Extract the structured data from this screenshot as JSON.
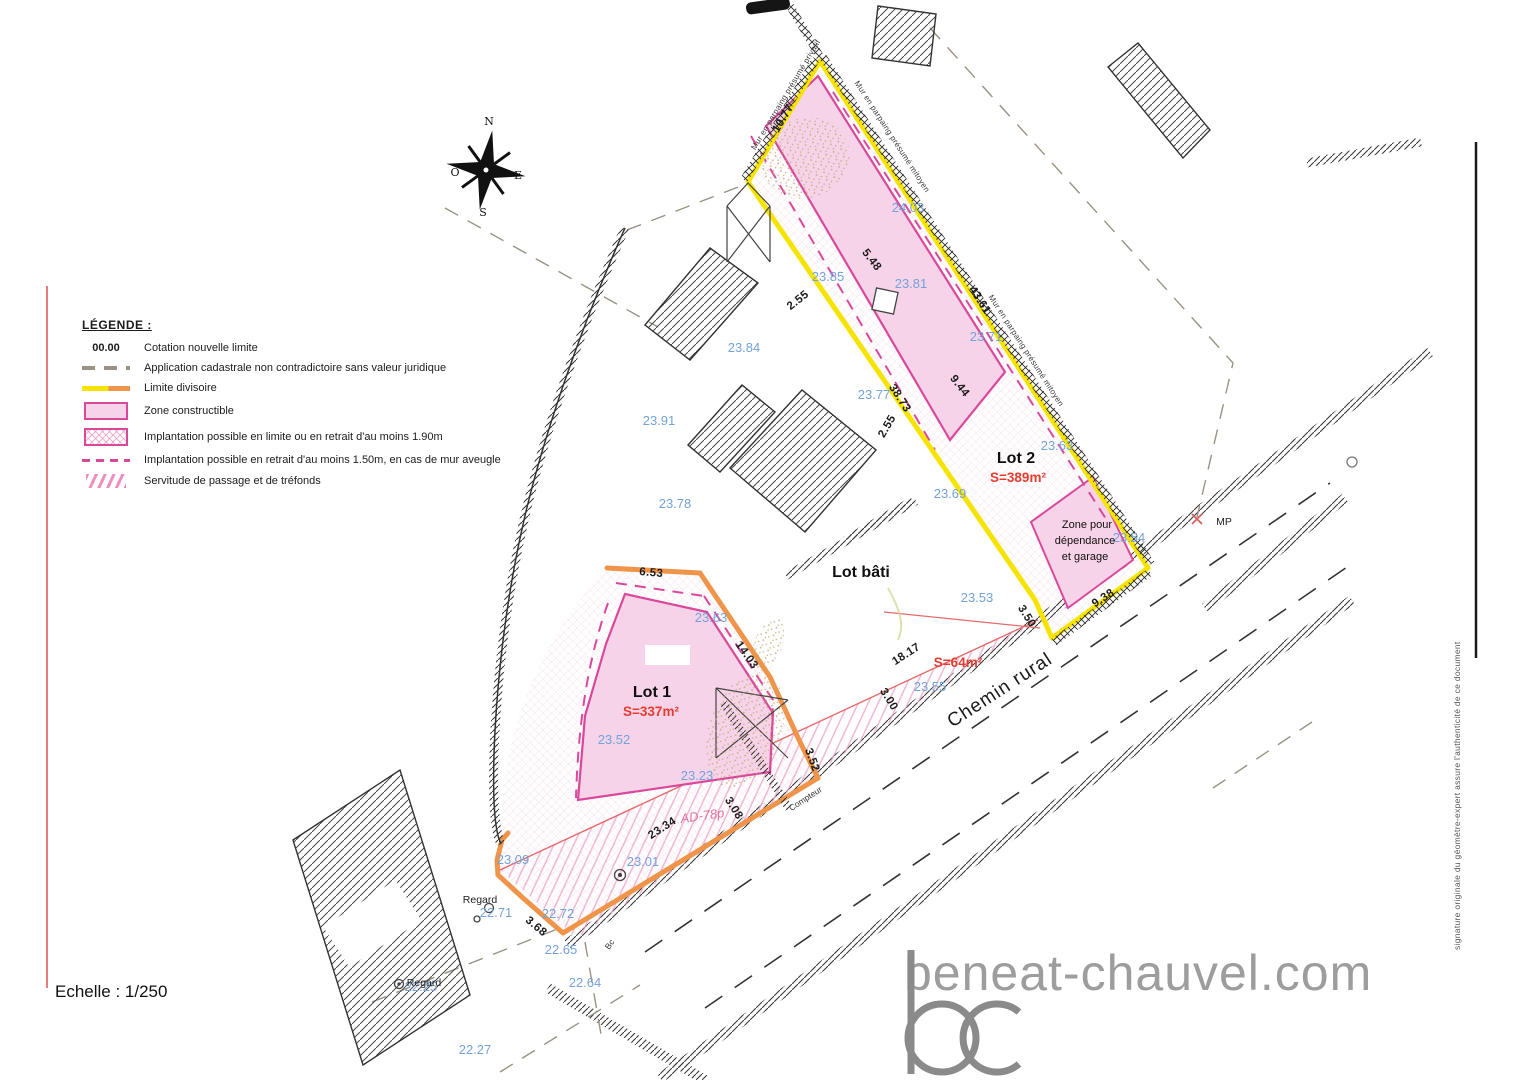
{
  "legend": {
    "title": "LÉGENDE :",
    "items": [
      {
        "symbol": "00.00",
        "label": "Cotation nouvelle limite"
      },
      {
        "symbol": "dashed-gray-line",
        "label": "Application cadastrale non contradictoire sans valeur juridique"
      },
      {
        "symbol": "yellow-orange-line",
        "label": "Limite divisoire"
      },
      {
        "symbol": "pink-rect",
        "label": "Zone constructible"
      },
      {
        "symbol": "pink-crosshatch-rect",
        "label": "Implantation possible en limite ou en retrait d'au moins 1.90m"
      },
      {
        "symbol": "pink-dashed-line",
        "label": "Implantation possible en retrait d'au moins 1.50m, en cas de mur aveugle"
      },
      {
        "symbol": "pink-hatch-rect",
        "label": "Servitude de passage et de tréfonds"
      }
    ]
  },
  "compass": {
    "n": "N",
    "e": "E",
    "s": "S",
    "o": "O"
  },
  "scale_label": "Echelle : 1/250",
  "footer": {
    "logo_monogram": "bc",
    "logo_text": "beneat-chauvel.com"
  },
  "signature_note": "signature originale du géomètre-expert assure l'authenticité de ce document",
  "colors": {
    "limite_yellow": "#f6e400",
    "limite_orange": "#ef9449",
    "zone_pink_fill": "#f7d3e9",
    "zone_pink_border": "#d9489b",
    "elevation_blue": "#74a3da",
    "area_red": "#e63c30",
    "logo_gray": "#8a8a8a"
  },
  "plan": {
    "labels": [
      {
        "t": "10.77",
        "x": 786,
        "y": 120,
        "r": -59,
        "c": "dim"
      },
      {
        "t": "43.61",
        "x": 977,
        "y": 302,
        "r": 57,
        "c": "dim"
      },
      {
        "t": "38.73",
        "x": 897,
        "y": 400,
        "r": 57,
        "c": "dim"
      },
      {
        "t": "9.44",
        "x": 957,
        "y": 388,
        "r": 52,
        "c": "dim"
      },
      {
        "t": "5.48",
        "x": 869,
        "y": 262,
        "r": 52,
        "c": "dim"
      },
      {
        "t": "2.55",
        "x": 800,
        "y": 303,
        "r": -38,
        "c": "dim"
      },
      {
        "t": "2.55",
        "x": 890,
        "y": 428,
        "r": -60,
        "c": "dim"
      },
      {
        "t": "6.53",
        "x": 651,
        "y": 576,
        "r": 5,
        "c": "dim"
      },
      {
        "t": "14.03",
        "x": 744,
        "y": 657,
        "r": 55,
        "c": "dim"
      },
      {
        "t": "3.52",
        "x": 809,
        "y": 761,
        "r": 70,
        "c": "dim"
      },
      {
        "t": "23.34",
        "x": 664,
        "y": 831,
        "r": -33,
        "c": "dim"
      },
      {
        "t": "3.08",
        "x": 731,
        "y": 810,
        "r": 58,
        "c": "dim"
      },
      {
        "t": "3.00",
        "x": 886,
        "y": 701,
        "r": 58,
        "c": "dim"
      },
      {
        "t": "18.17",
        "x": 908,
        "y": 657,
        "r": -33,
        "c": "dim"
      },
      {
        "t": "3.50",
        "x": 1024,
        "y": 618,
        "r": 58,
        "c": "dim"
      },
      {
        "t": "9.38",
        "x": 1105,
        "y": 601,
        "r": -33,
        "c": "dim"
      },
      {
        "t": "3.68",
        "x": 534,
        "y": 929,
        "r": 40,
        "c": "dim"
      },
      {
        "t": "23.84",
        "x": 744,
        "y": 352,
        "r": 0,
        "c": "elev"
      },
      {
        "t": "23.91",
        "x": 659,
        "y": 425,
        "r": 0,
        "c": "elev"
      },
      {
        "t": "23.78",
        "x": 675,
        "y": 508,
        "r": 0,
        "c": "elev"
      },
      {
        "t": "23.85",
        "x": 828,
        "y": 281,
        "r": 0,
        "c": "elev"
      },
      {
        "t": "23.81",
        "x": 911,
        "y": 288,
        "r": 0,
        "c": "elev"
      },
      {
        "t": "24.03",
        "x": 908,
        "y": 212,
        "r": 0,
        "c": "elev"
      },
      {
        "t": "23.71",
        "x": 986,
        "y": 341,
        "r": 0,
        "c": "elev"
      },
      {
        "t": "23.77",
        "x": 874,
        "y": 399,
        "r": 0,
        "c": "elev"
      },
      {
        "t": "23.63",
        "x": 1057,
        "y": 450,
        "r": 0,
        "c": "elev"
      },
      {
        "t": "23.69",
        "x": 950,
        "y": 498,
        "r": 0,
        "c": "elev"
      },
      {
        "t": "23.53",
        "x": 977,
        "y": 602,
        "r": 0,
        "c": "elev"
      },
      {
        "t": "23.54",
        "x": 1129,
        "y": 542,
        "r": 0,
        "c": "elev"
      },
      {
        "t": "23.55",
        "x": 930,
        "y": 691,
        "r": 0,
        "c": "elev"
      },
      {
        "t": "23.63",
        "x": 711,
        "y": 622,
        "r": 0,
        "c": "elev"
      },
      {
        "t": "23.52",
        "x": 614,
        "y": 744,
        "r": 0,
        "c": "elev"
      },
      {
        "t": "23.23",
        "x": 697,
        "y": 780,
        "r": 0,
        "c": "elev"
      },
      {
        "t": "23.09",
        "x": 513,
        "y": 864,
        "r": 0,
        "c": "elev"
      },
      {
        "t": "23.01",
        "x": 643,
        "y": 866,
        "r": 0,
        "c": "elev"
      },
      {
        "t": "22.71",
        "x": 496,
        "y": 917,
        "r": 0,
        "c": "elev"
      },
      {
        "t": "22.72",
        "x": 558,
        "y": 918,
        "r": 0,
        "c": "elev"
      },
      {
        "t": "22.65",
        "x": 561,
        "y": 954,
        "r": 0,
        "c": "elev"
      },
      {
        "t": "22.64",
        "x": 585,
        "y": 987,
        "r": 0,
        "c": "elev"
      },
      {
        "t": "22.25",
        "x": 421,
        "y": 991,
        "r": 0,
        "c": "elev"
      },
      {
        "t": "22.27",
        "x": 475,
        "y": 1054,
        "r": 0,
        "c": "elev"
      },
      {
        "t": "Lot 2",
        "x": 1016,
        "y": 463,
        "r": 0,
        "c": "lot"
      },
      {
        "t": "S=389m²",
        "x": 1018,
        "y": 482,
        "r": 0,
        "c": "red"
      },
      {
        "t": "Lot 1",
        "x": 652,
        "y": 697,
        "r": 0,
        "c": "lot"
      },
      {
        "t": "S=337m²",
        "x": 651,
        "y": 716,
        "r": 0,
        "c": "red"
      },
      {
        "t": "S=64m²",
        "x": 958,
        "y": 667,
        "r": 0,
        "c": "red",
        "s": 12
      },
      {
        "t": "Lot bâti",
        "x": 861,
        "y": 577,
        "r": 0,
        "c": "lot",
        "s": 15
      },
      {
        "t": "Zone pour",
        "x": 1087,
        "y": 528,
        "r": 0,
        "c": "zsmall"
      },
      {
        "t": "dépendance",
        "x": 1085,
        "y": 544,
        "r": 0,
        "c": "zsmall"
      },
      {
        "t": "et garage",
        "x": 1085,
        "y": 560,
        "r": 0,
        "c": "zsmall"
      },
      {
        "t": "MP",
        "x": 1224,
        "y": 525,
        "r": 0,
        "c": "note"
      },
      {
        "t": "Regard",
        "x": 480,
        "y": 903,
        "r": 0,
        "c": "note"
      },
      {
        "t": "Regard",
        "x": 424,
        "y": 986,
        "r": 0,
        "c": "note",
        "s": 9
      },
      {
        "t": "Compteur",
        "x": 807,
        "y": 801,
        "r": -33,
        "c": "tiny"
      },
      {
        "t": "Bc",
        "x": 612,
        "y": 946,
        "r": -55,
        "c": "tiny"
      },
      {
        "t": "AD-78p",
        "x": 703,
        "y": 820,
        "r": -8,
        "c": "parcel"
      },
      {
        "t": "Chemin rural",
        "x": 1003,
        "y": 695,
        "r": -33,
        "c": "road"
      },
      {
        "t": "Mur en parpaing présumé privatif",
        "x": 788,
        "y": 96,
        "r": -59,
        "c": "wall"
      },
      {
        "t": "Mur en parpaing présumé mitoyen",
        "x": 890,
        "y": 138,
        "r": 57,
        "c": "wall"
      },
      {
        "t": "Mur en parpaing présumé mitoyen",
        "x": 1024,
        "y": 352,
        "r": 57,
        "c": "wall"
      }
    ]
  }
}
